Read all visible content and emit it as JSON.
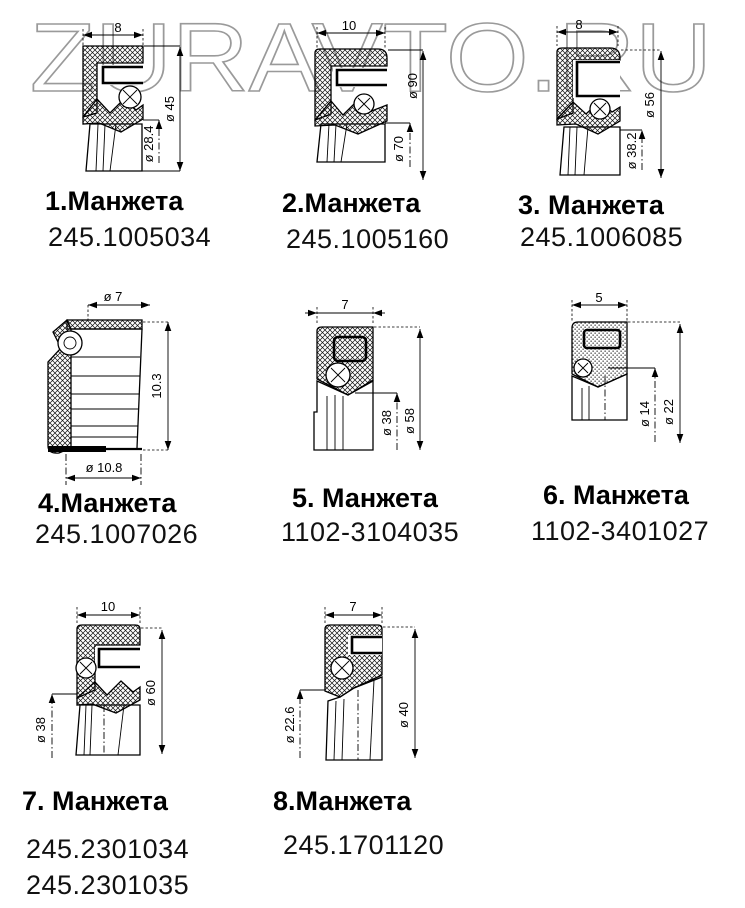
{
  "watermark": {
    "text": "ZURAVTO.RU"
  },
  "colors": {
    "line": "#000000",
    "watermark_outline": "#9a9a9a",
    "background": "#ffffff"
  },
  "seals": [
    {
      "caption": "1.Манжета",
      "part_numbers": [
        "245.1005034"
      ],
      "dim_top": "8",
      "dim_outer": "ø 45",
      "dim_inner": "ø 28.4"
    },
    {
      "caption": "2.Манжета",
      "part_numbers": [
        "245.1005160"
      ],
      "dim_top": "10",
      "dim_outer": "ø 90",
      "dim_inner": "ø 70"
    },
    {
      "caption": "3. Манжета",
      "part_numbers": [
        "245.1006085"
      ],
      "dim_top": "8",
      "dim_outer": "ø 56",
      "dim_inner": "ø 38.2"
    },
    {
      "caption": "4.Манжета",
      "part_numbers": [
        "245.1007026"
      ],
      "dim_top": "ø 7",
      "dim_side": "10.3",
      "dim_bottom": "ø 10.8"
    },
    {
      "caption": "5. Манжета",
      "part_numbers": [
        "1102-3104035"
      ],
      "dim_top": "7",
      "dim_outer": "ø 58",
      "dim_inner": "ø 38"
    },
    {
      "caption": "6. Манжета",
      "part_numbers": [
        "1102-3401027"
      ],
      "dim_top": "5",
      "dim_outer": "ø 22",
      "dim_inner": "ø 14"
    },
    {
      "caption": "7. Манжета",
      "part_numbers": [
        "245.2301034",
        "245.2301035"
      ],
      "dim_top": "10",
      "dim_outer": "ø 60",
      "dim_inner": "ø 38"
    },
    {
      "caption": "8.Манжета",
      "part_numbers": [
        "245.1701120"
      ],
      "dim_top": "7",
      "dim_outer": "ø 40",
      "dim_inner": "ø 22.6"
    }
  ]
}
